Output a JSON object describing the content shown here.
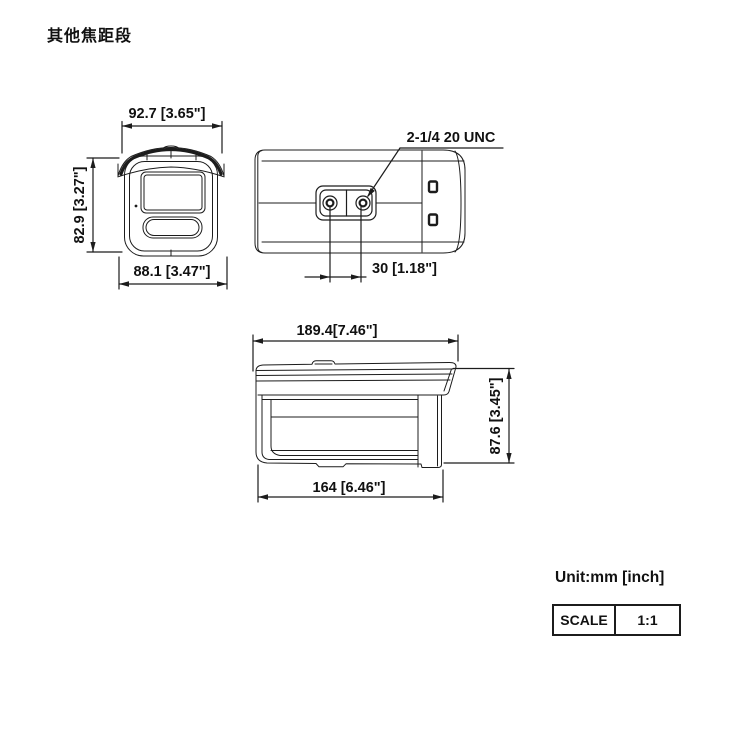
{
  "title": "其他焦距段",
  "front_view": {
    "dim_width_top": "92.7 [3.65\"]",
    "dim_height_left": "82.9 [3.27\"]",
    "dim_width_bottom": "88.1 [3.47\"]"
  },
  "bottom_view": {
    "thread_spec": "2-1/4 20 UNC",
    "dim_hole_spacing": "30 [1.18\"]"
  },
  "side_view": {
    "dim_length_overall": "189.4[7.46\"]",
    "dim_height_right": "87.6 [3.45\"]",
    "dim_length_body": "164 [6.46\"]"
  },
  "footer": {
    "unit_note": "Unit:mm [inch]",
    "scale_label": "SCALE",
    "scale_value": "1:1"
  },
  "colors": {
    "line": "#1c1c1c",
    "text": "#111111",
    "background": "#ffffff"
  }
}
